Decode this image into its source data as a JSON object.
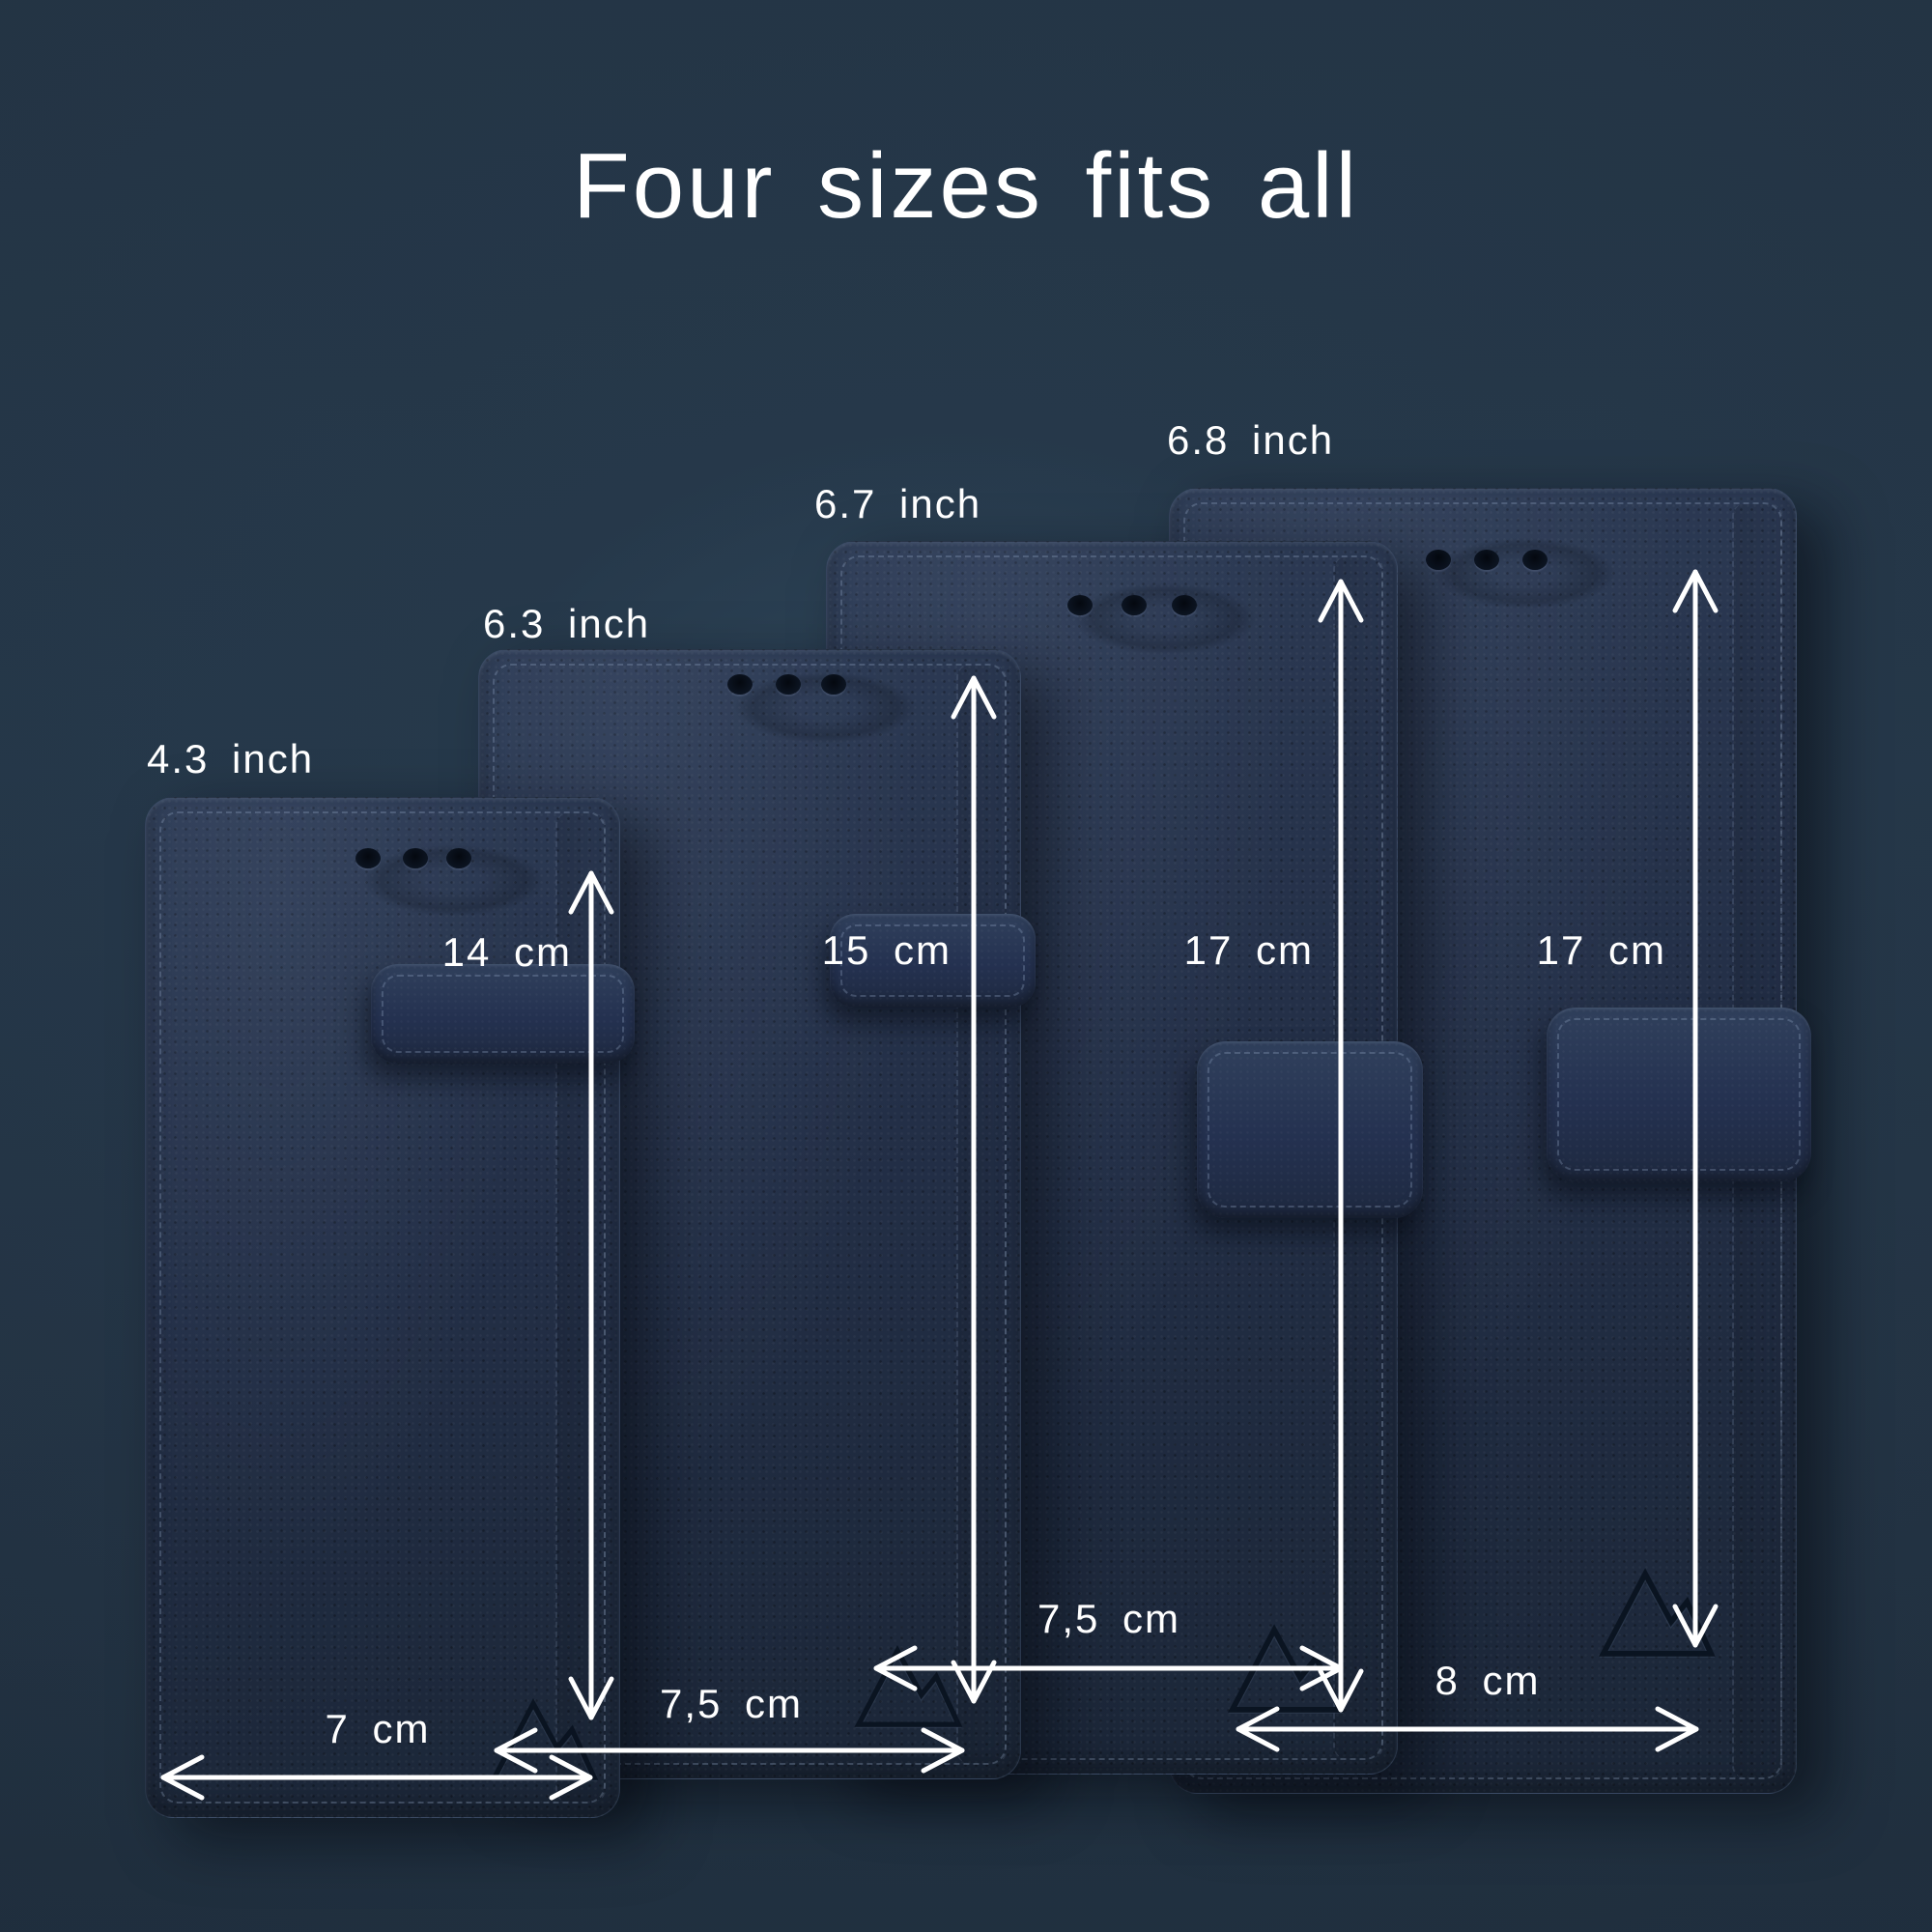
{
  "title": "Four sizes fits all",
  "cases": [
    {
      "id": "case-1",
      "screen_size": "4.3 inch",
      "height_cm": "14 cm",
      "width_cm": "7 cm"
    },
    {
      "id": "case-2",
      "screen_size": "6.3 inch",
      "height_cm": "15 cm",
      "width_cm": "7,5 cm"
    },
    {
      "id": "case-3",
      "screen_size": "6.7 inch",
      "height_cm": "17 cm",
      "width_cm": "7,5 cm"
    },
    {
      "id": "case-4",
      "screen_size": "6.8 inch",
      "height_cm": "17 cm",
      "width_cm": "8 cm"
    }
  ],
  "colors": {
    "background": "#243445",
    "glow": "#31495d",
    "case_surface": "#232f45",
    "annotation_text": "#ffffff",
    "arrow": "#ffffff"
  }
}
